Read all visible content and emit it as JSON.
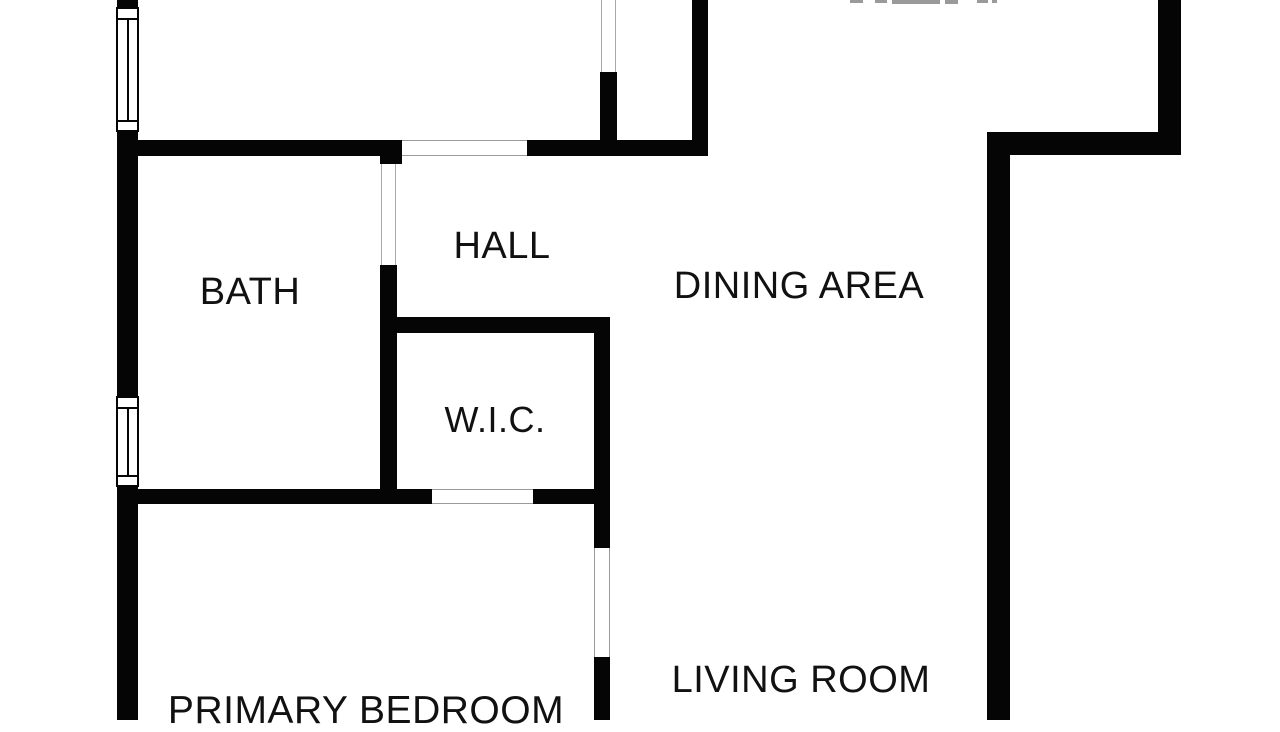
{
  "plan": {
    "type": "floor-plan",
    "background_color": "#ffffff",
    "wall_color": "#050505",
    "text_color": "#111111",
    "door_line_color": "#9a9a9a",
    "rooms": {
      "bath": {
        "label": "BATH"
      },
      "hall": {
        "label": "HALL"
      },
      "dining": {
        "label": "DINING AREA"
      },
      "wic": {
        "label": "W.I.C."
      },
      "living": {
        "label": "LIVING ROOM"
      },
      "primary": {
        "label": "PRIMARY BEDROOM"
      }
    },
    "features": {
      "windows": [
        "left-wall-upper-window",
        "left-wall-lower-window"
      ],
      "openings": [
        "hall-top-doorway",
        "bath-doorway",
        "top-center-doorway",
        "primary-bedroom-doorway",
        "bedroom-living-opening"
      ]
    }
  }
}
